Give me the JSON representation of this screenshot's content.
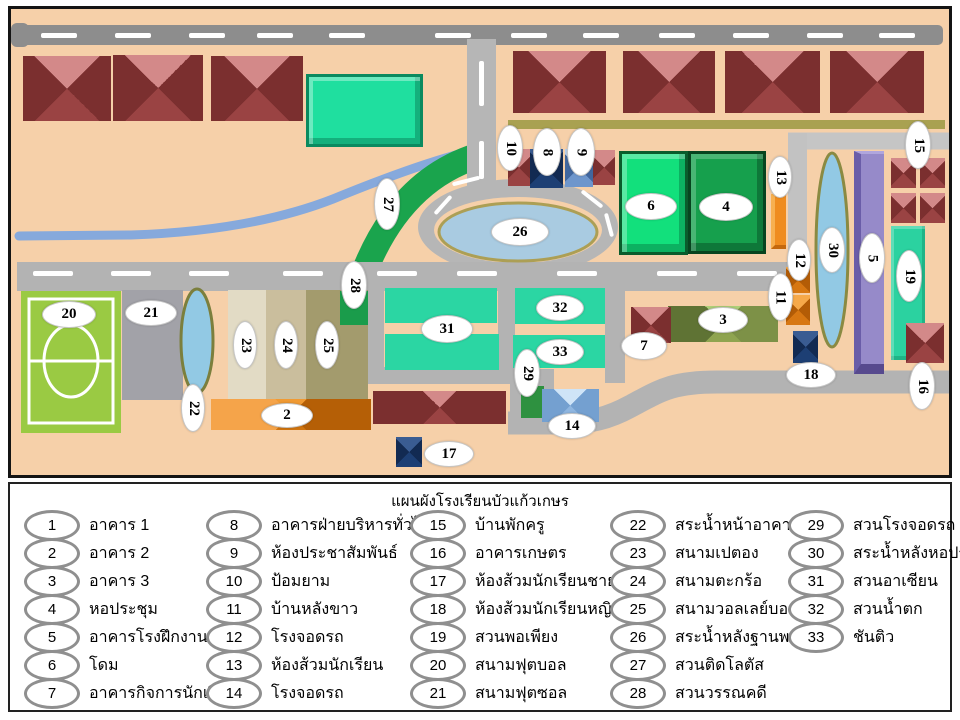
{
  "legend": {
    "title": "แผนผังโรงเรียนบัวแก้วเกษร",
    "columns": [
      {
        "items": [
          {
            "num": "1",
            "label": "อาคาร 1"
          },
          {
            "num": "2",
            "label": "อาคาร 2"
          },
          {
            "num": "3",
            "label": "อาคาร 3"
          },
          {
            "num": "4",
            "label": "หอประชุม"
          },
          {
            "num": "5",
            "label": "อาคารโรงฝึกงาน"
          },
          {
            "num": "6",
            "label": "โดม"
          },
          {
            "num": "7",
            "label": "อาคารกิจการนักเรียน"
          }
        ]
      },
      {
        "items": [
          {
            "num": "8",
            "label": "อาคารฝ่ายบริหารทั่วไป"
          },
          {
            "num": "9",
            "label": "ห้องประชาสัมพันธ์"
          },
          {
            "num": "10",
            "label": "ป้อมยาม"
          },
          {
            "num": "11",
            "label": "บ้านหลังขาว"
          },
          {
            "num": "12",
            "label": "โรงจอดรถ"
          },
          {
            "num": "13",
            "label": "ห้องส้วมนักเรียน"
          },
          {
            "num": "14",
            "label": "โรงจอดรถ"
          }
        ]
      },
      {
        "items": [
          {
            "num": "15",
            "label": "บ้านพักครู"
          },
          {
            "num": "16",
            "label": "อาคารเกษตร"
          },
          {
            "num": "17",
            "label": "ห้องส้วมนักเรียนชาย"
          },
          {
            "num": "18",
            "label": "ห้องส้วมนักเรียนหญิง"
          },
          {
            "num": "19",
            "label": "สวนพอเพียง"
          },
          {
            "num": "20",
            "label": "สนามฟุตบอล"
          },
          {
            "num": "21",
            "label": "สนามฟุตซอล"
          }
        ]
      },
      {
        "items": [
          {
            "num": "22",
            "label": "สระน้ำหน้าอาคาร 2"
          },
          {
            "num": "23",
            "label": "สนามเปตอง"
          },
          {
            "num": "24",
            "label": "สนามตะกร้อ"
          },
          {
            "num": "25",
            "label": "สนามวอลเลย์บอล"
          },
          {
            "num": "26",
            "label": "สระน้ำหลังฐานพระ"
          },
          {
            "num": "27",
            "label": "สวนติดโลตัส"
          },
          {
            "num": "28",
            "label": "สวนวรรณคดี"
          }
        ]
      },
      {
        "items": [
          {
            "num": "29",
            "label": "สวนโรงจอดรถ"
          },
          {
            "num": "30",
            "label": "สระน้ำหลังหอประชุม"
          },
          {
            "num": "31",
            "label": "สวนอาเซียน"
          },
          {
            "num": "32",
            "label": "สวนน้ำตก"
          },
          {
            "num": "33",
            "label": "ชันติว"
          }
        ]
      }
    ]
  },
  "map": {
    "markers": {
      "m2": "2",
      "m3": "3",
      "m4": "4",
      "m5": "5",
      "m6": "6",
      "m7": "7",
      "m8": "8",
      "m9": "9",
      "m10": "10",
      "m11": "11",
      "m12": "12",
      "m13": "13",
      "m14": "14",
      "m15": "15",
      "m16": "16",
      "m17": "17",
      "m18": "18",
      "m19": "19",
      "m20": "20",
      "m21": "21",
      "m22": "22",
      "m23": "23",
      "m24": "24",
      "m25": "25",
      "m26": "26",
      "m27": "27",
      "m28": "28",
      "m29": "29",
      "m30": "30",
      "m31": "31",
      "m32": "32",
      "m33": "33"
    }
  },
  "colors": {
    "ground_peach": "#f6d0a9",
    "road_gray": "#b3b3b3",
    "top_road_gray": "#8d8d8d",
    "roof_red": "#9a4343",
    "roof_red_light": "#d38989",
    "teal_building": "#2bd6a3",
    "green_bright": "#12e07c",
    "green_dark": "#16a04d",
    "orange": "#ef8c1f",
    "purple": "#968ac9",
    "navy": "#1d3f74",
    "pond_blue": "#a9cbe1",
    "pond_border_khaki": "#ac9f55",
    "stream_blue": "#86a9dc",
    "field_green": "#9aca43",
    "khaki_band": "#a9a151",
    "band_green": "#1aa44d"
  }
}
